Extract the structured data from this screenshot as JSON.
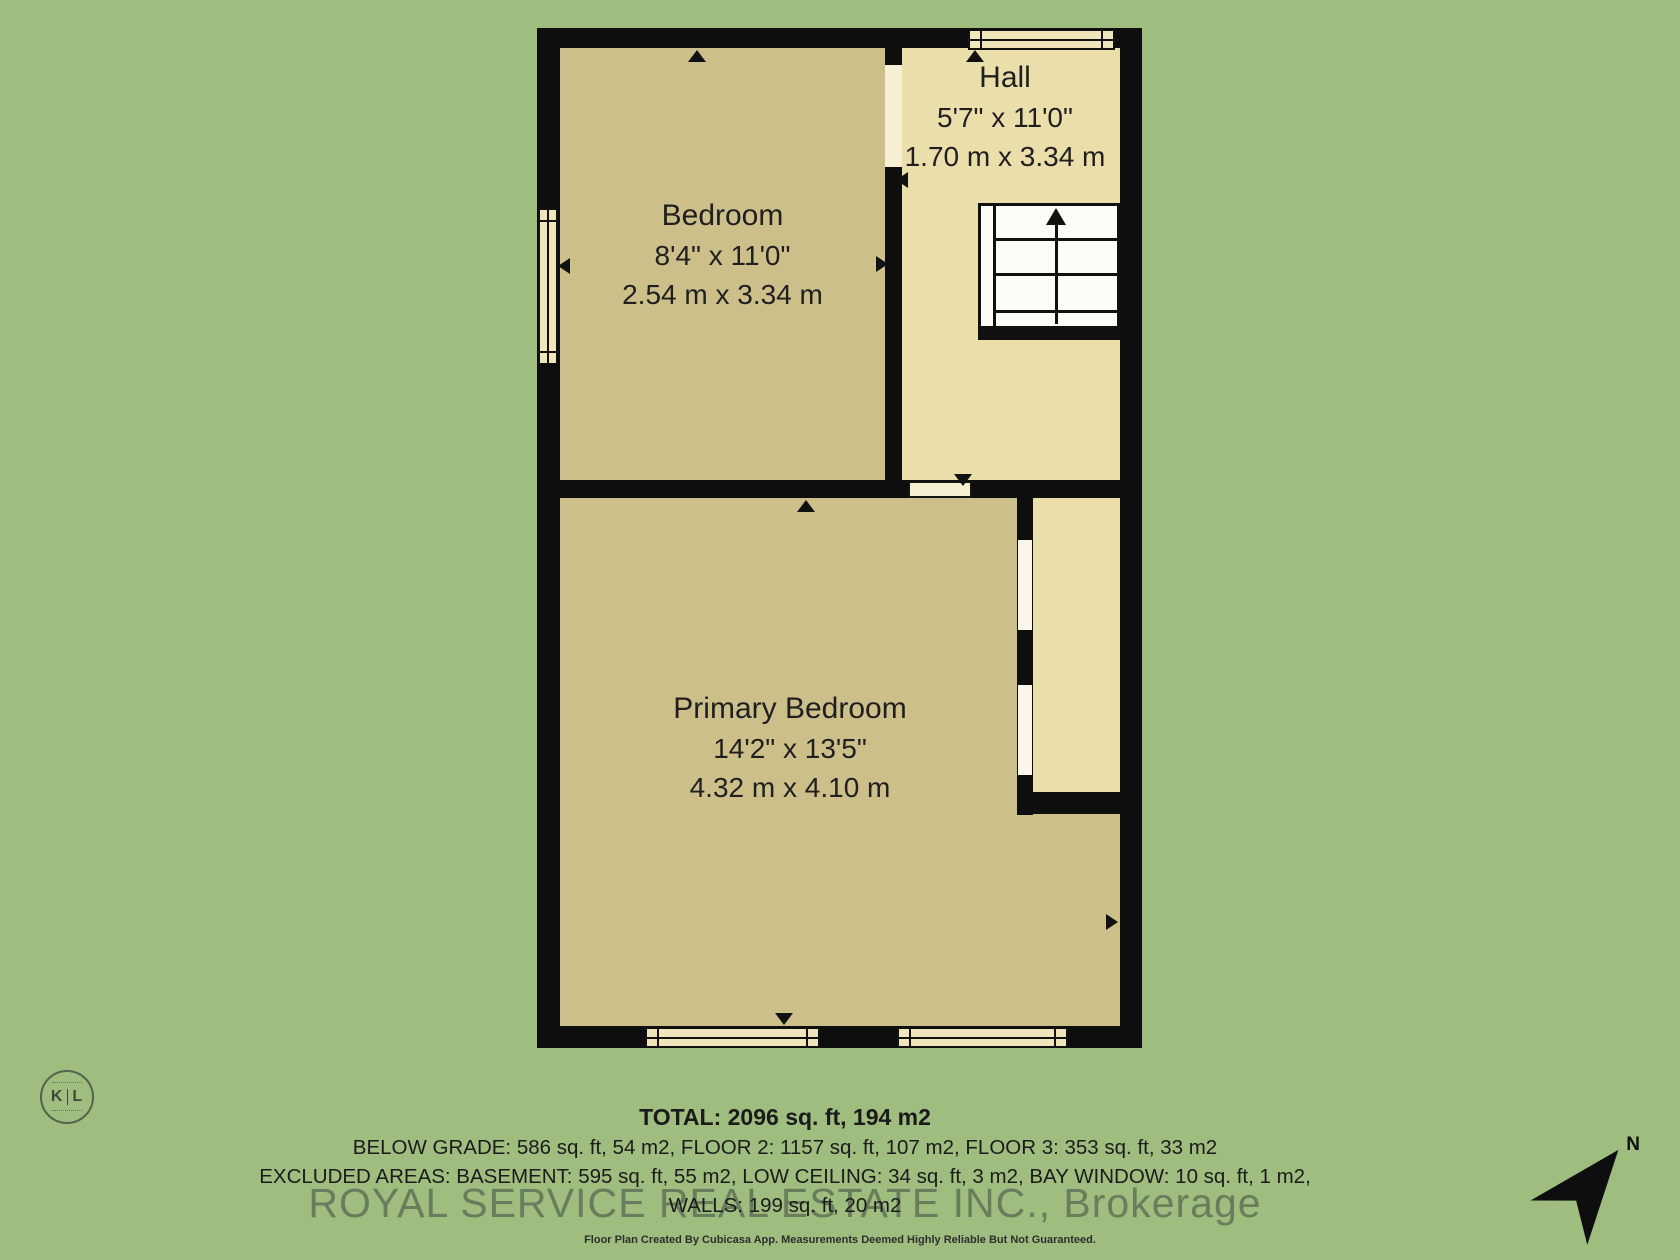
{
  "rooms": [
    {
      "name": "Bedroom",
      "dims_ft": "8'4\" x 11'0\"",
      "dims_m": "2.54 m x 3.34 m"
    },
    {
      "name": "Hall",
      "dims_ft": "5'7\" x 11'0\"",
      "dims_m": "1.70 m x 3.34 m"
    },
    {
      "name": "Primary Bedroom",
      "dims_ft": "14'2\" x 13'5\"",
      "dims_m": "4.32 m x 4.10 m"
    }
  ],
  "footer": {
    "total": "TOTAL: 2096 sq. ft, 194 m2",
    "line2": "BELOW GRADE: 586 sq. ft, 54 m2, FLOOR 2: 1157 sq. ft, 107 m2, FLOOR 3: 353 sq. ft, 33 m2",
    "line3": "EXCLUDED AREAS: BASEMENT: 595 sq. ft, 55 m2, LOW CEILING: 34 sq. ft, 3 m2, BAY WINDOW: 10 sq. ft, 1 m2,",
    "line4": "WALLS: 199 sq. ft, 20 m2",
    "disclaimer": "Floor Plan Created By Cubicasa App. Measurements Deemed Highly Reliable But Not Guaranteed."
  },
  "watermark": "ROYAL SERVICE REAL ESTATE INC., Brokerage",
  "logo": {
    "letter_left": "K",
    "letter_right": "L"
  },
  "compass": {
    "label": "N"
  },
  "colors": {
    "background_green": "#9ebd7f",
    "room_fill": "#cdbf8a",
    "hall_fill": "#eadeab",
    "wall_black": "#0e0e0e",
    "window_fill": "#f0e4bb",
    "stairs_fill": "#fdfcf6",
    "text": "#1f1f1f",
    "watermark_gray": "rgba(68,78,68,0.58)"
  }
}
